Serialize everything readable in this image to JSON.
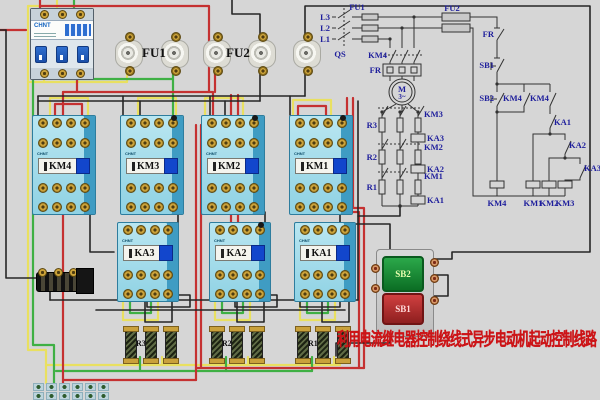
{
  "title": {
    "text": "利用电流继电器控制绕线式异步电动机起动控制线路"
  },
  "breaker": {
    "brand": "CHNT"
  },
  "fuse_labels": {
    "fu1": "FU1",
    "fu2": "FU2"
  },
  "contactors": {
    "brand": "CHNT",
    "row1": [
      {
        "label": "KM4"
      },
      {
        "label": "KM3"
      },
      {
        "label": "KM2"
      },
      {
        "label": "KM1"
      }
    ],
    "row2": [
      {
        "label": "KA3"
      },
      {
        "label": "KA2"
      },
      {
        "label": "KA1"
      }
    ]
  },
  "buttons": {
    "start": "SB2",
    "stop": "SB1"
  },
  "resistors": [
    {
      "label": "R3"
    },
    {
      "label": "R2"
    },
    {
      "label": "R1"
    }
  ],
  "schematic": {
    "phases": [
      "L3",
      "L2",
      "L1"
    ],
    "qs": "QS",
    "fu1": "FU1",
    "fu2": "FU2",
    "main_km": "KM4",
    "fr": "FR",
    "motor": "M",
    "motor_phase": "3~",
    "rotor": {
      "km3": "KM3",
      "r3": "R3",
      "ka3": "KA3",
      "km2": "KM2",
      "r2": "R2",
      "ka2": "KA2",
      "km1": "KM1",
      "r1": "R1",
      "ka1": "KA1"
    },
    "control": {
      "fr": "FR",
      "sb1": "SB1",
      "sb2": "SB2",
      "km4_selfhold": "KM4",
      "km4_aux": "KM4",
      "ka1": "KA1",
      "ka2": "KA2",
      "ka3": "KA3",
      "coil_km4": "KM4",
      "coil_km1": "KM1",
      "coil_km2": "KM2",
      "coil_km3": "KM3"
    }
  },
  "colors": {
    "wire_red": "#c53131",
    "wire_yellow": "#e9e060",
    "wire_green": "#3fb044",
    "wire_black": "#262626",
    "schematic_label": "#1e1e9c",
    "title_red": "#cc1417",
    "contactor_body": "#8fd6e6",
    "background": "#d6d6d6"
  }
}
